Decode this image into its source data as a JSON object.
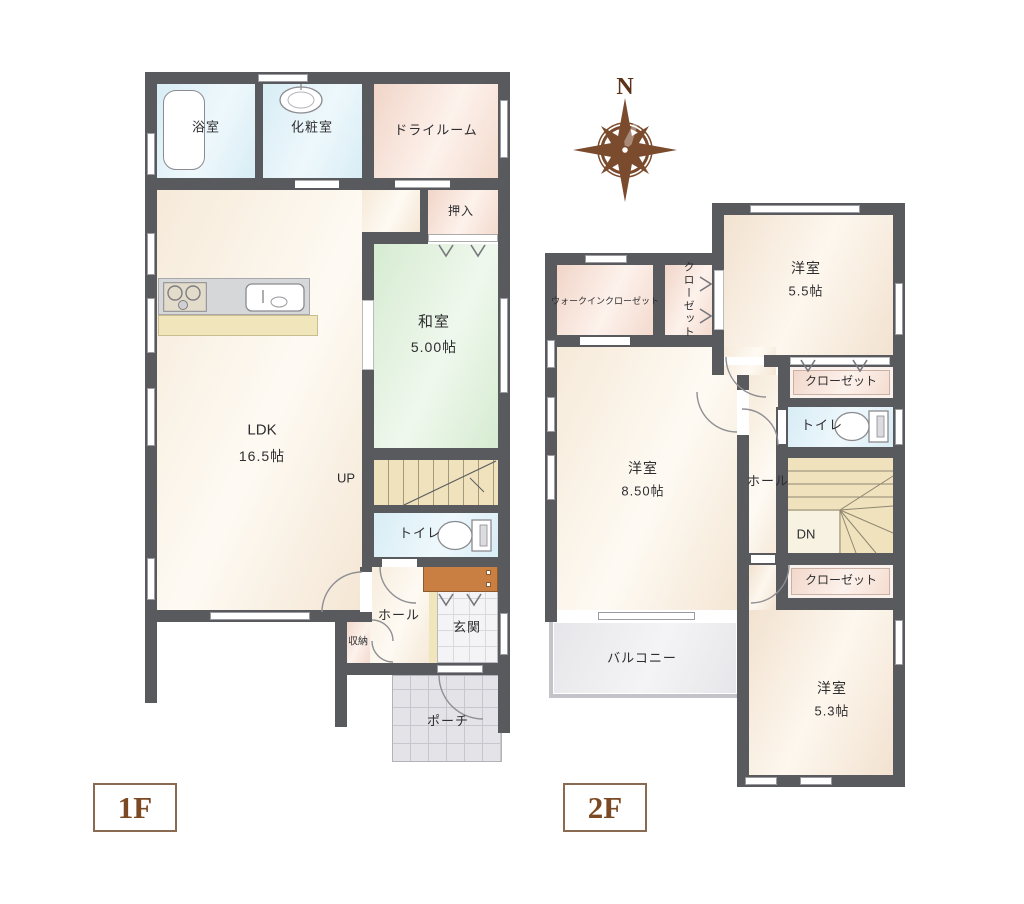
{
  "compass": {
    "north_label": "N"
  },
  "floor1": {
    "badge": "1F",
    "rooms": {
      "bath": "浴室",
      "powder_room": "化粧室",
      "dry_room": "ドライルーム",
      "oshiire": "押入",
      "washitsu": {
        "name": "和室",
        "size": "5.00帖"
      },
      "ldk": {
        "name": "LDK",
        "size": "16.5帖"
      },
      "stairs_up": "UP",
      "toilet": "トイレ",
      "hall": "ホール",
      "storage": "収納",
      "entrance": "玄関",
      "porch": "ポーチ"
    }
  },
  "floor2": {
    "badge": "2F",
    "rooms": {
      "walk_in_closet": "ウォークインクローゼット",
      "closet_a": "クローゼット",
      "bedroom1": {
        "name": "洋室",
        "size": "5.5帖"
      },
      "closet_b": "クローゼット",
      "toilet": "トイレ",
      "bedroom2": {
        "name": "洋室",
        "size": "8.50帖"
      },
      "hall": "ホール",
      "stairs_down": "DN",
      "closet_c": "クローゼット",
      "bedroom3": {
        "name": "洋室",
        "size": "5.3帖"
      },
      "balcony": "バルコニー"
    }
  },
  "colors": {
    "wall": "#595a5e",
    "floor_beige": "#f2e2d0",
    "tatami_green": "#d6ebd1",
    "wet_area_blue": "#d8edf5",
    "closet_pink": "#f1d5c8",
    "stair_cream": "#efe2bd",
    "cabinet_orange": "#c87f41",
    "accent_brown": "#7b4a24"
  }
}
